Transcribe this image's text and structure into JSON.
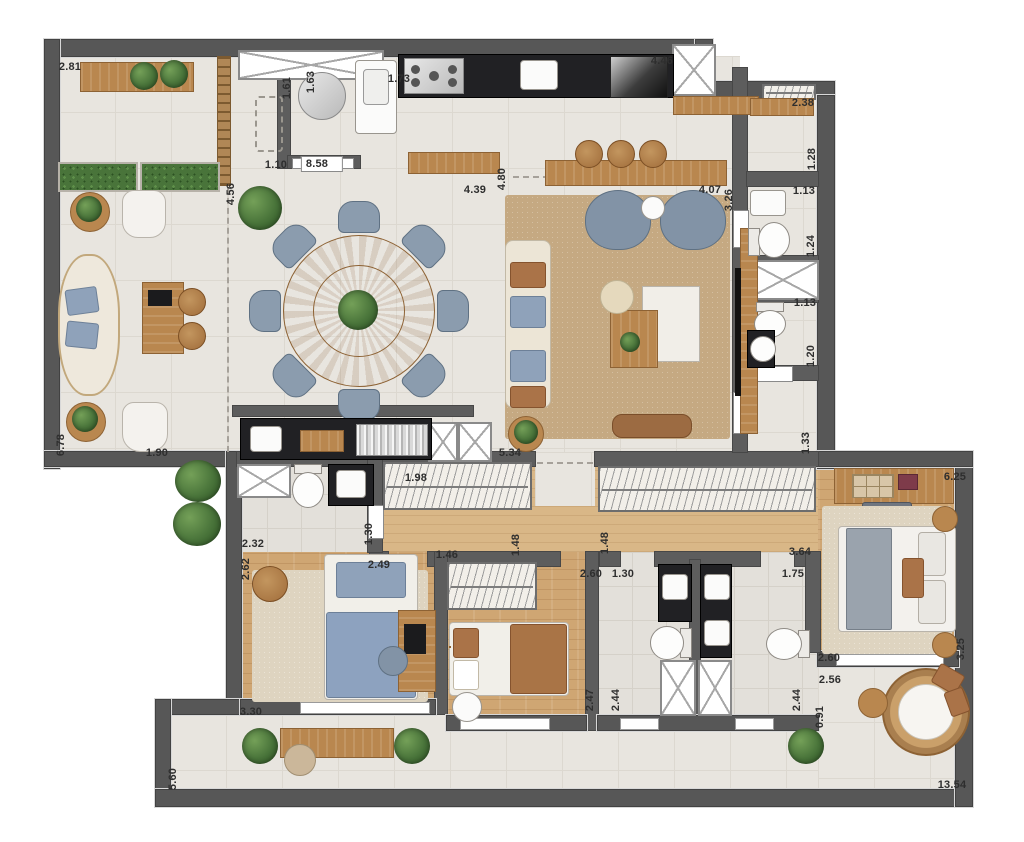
{
  "meta": {
    "type": "apartment-floor-plan",
    "units": "m",
    "text_language": "numeric-dimensions-only"
  },
  "palette": {
    "wall": "#575757",
    "tile_floor": "#e8e5df",
    "wood_floor": "#cfa673",
    "corridor_wood": "#d9b787",
    "rug_tan": "#c5a982",
    "rug_beige": "#ded4c0",
    "counter_black": "#212124",
    "furniture_wood": "#b9874f",
    "chair_blue": "#8b9cae",
    "bed_blue": "#8fa2ba",
    "plant_green": "#49743a",
    "fixture_white": "#fbfbfa",
    "label_text": "#2e2e2e"
  },
  "dimensions": [
    {
      "v": "2.81",
      "x": 70,
      "y": 67,
      "rot": 0
    },
    {
      "v": "1.61",
      "x": 287,
      "y": 88,
      "rot": -90
    },
    {
      "v": "1.63",
      "x": 311,
      "y": 82,
      "rot": -90
    },
    {
      "v": "1.73",
      "x": 399,
      "y": 79,
      "rot": 0
    },
    {
      "v": "4.46",
      "x": 662,
      "y": 61,
      "rot": 0
    },
    {
      "v": "2.38",
      "x": 803,
      "y": 103,
      "rot": 0
    },
    {
      "v": "1.28",
      "x": 812,
      "y": 159,
      "rot": -90
    },
    {
      "v": "1.13",
      "x": 804,
      "y": 191,
      "rot": 0
    },
    {
      "v": "1.24",
      "x": 811,
      "y": 246,
      "rot": -90
    },
    {
      "v": "1.13",
      "x": 805,
      "y": 303,
      "rot": 0
    },
    {
      "v": "1.20",
      "x": 811,
      "y": 356,
      "rot": -90
    },
    {
      "v": "1.33",
      "x": 806,
      "y": 443,
      "rot": -90
    },
    {
      "v": "3.26",
      "x": 729,
      "y": 200,
      "rot": -90
    },
    {
      "v": "4.07",
      "x": 710,
      "y": 190,
      "rot": 0
    },
    {
      "v": "4.80",
      "x": 502,
      "y": 179,
      "rot": -90
    },
    {
      "v": "4.39",
      "x": 475,
      "y": 190,
      "rot": 0
    },
    {
      "v": "4.56",
      "x": 231,
      "y": 194,
      "rot": -90
    },
    {
      "v": "1.10",
      "x": 276,
      "y": 165,
      "rot": 0
    },
    {
      "v": "8.58",
      "x": 322,
      "y": 164,
      "rot": 0,
      "badge": true
    },
    {
      "v": "6.78",
      "x": 61,
      "y": 445,
      "rot": -90
    },
    {
      "v": "1.90",
      "x": 157,
      "y": 453,
      "rot": 0
    },
    {
      "v": "5.34",
      "x": 510,
      "y": 453,
      "rot": 0
    },
    {
      "v": "1.98",
      "x": 416,
      "y": 478,
      "rot": 0
    },
    {
      "v": "6.25",
      "x": 955,
      "y": 477,
      "rot": 0
    },
    {
      "v": "2.32",
      "x": 253,
      "y": 544,
      "rot": 0
    },
    {
      "v": "1.30",
      "x": 369,
      "y": 534,
      "rot": -90
    },
    {
      "v": "2.49",
      "x": 379,
      "y": 565,
      "rot": 0
    },
    {
      "v": "1.46",
      "x": 447,
      "y": 555,
      "rot": 0
    },
    {
      "v": "1.48",
      "x": 516,
      "y": 545,
      "rot": -90
    },
    {
      "v": "1.48",
      "x": 605,
      "y": 543,
      "rot": -90
    },
    {
      "v": "3.64",
      "x": 800,
      "y": 552,
      "rot": 0
    },
    {
      "v": "2.62",
      "x": 246,
      "y": 569,
      "rot": -90
    },
    {
      "v": "2.60",
      "x": 591,
      "y": 574,
      "rot": 0
    },
    {
      "v": "1.30",
      "x": 623,
      "y": 574,
      "rot": 0
    },
    {
      "v": "1.75",
      "x": 793,
      "y": 574,
      "rot": 0
    },
    {
      "v": "2.47",
      "x": 590,
      "y": 700,
      "rot": -90
    },
    {
      "v": "2.44",
      "x": 616,
      "y": 700,
      "rot": -90
    },
    {
      "v": "2.44",
      "x": 797,
      "y": 700,
      "rot": -90
    },
    {
      "v": "2.60",
      "x": 829,
      "y": 658,
      "rot": 0
    },
    {
      "v": "2.56",
      "x": 830,
      "y": 680,
      "rot": 0
    },
    {
      "v": "3.25",
      "x": 961,
      "y": 649,
      "rot": -90
    },
    {
      "v": "0.91",
      "x": 820,
      "y": 717,
      "rot": -90
    },
    {
      "v": "3.30",
      "x": 251,
      "y": 712,
      "rot": 0
    },
    {
      "v": "5.60",
      "x": 173,
      "y": 779,
      "rot": -90
    },
    {
      "v": "13.54",
      "x": 952,
      "y": 785,
      "rot": 0
    }
  ]
}
